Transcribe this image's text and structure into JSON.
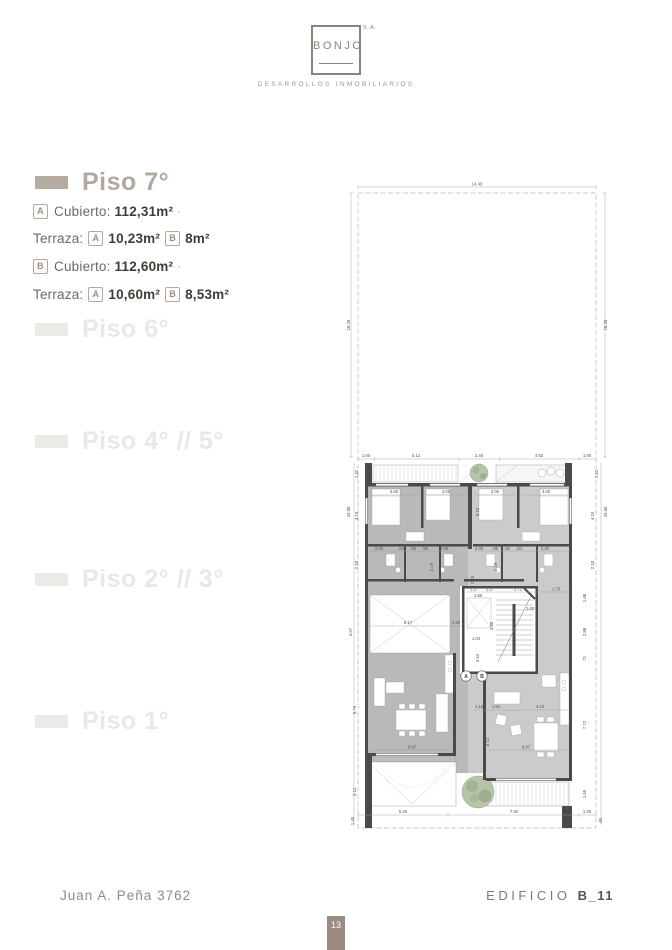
{
  "header": {
    "logo_text": "BONJO",
    "logo_suffix": "S.A.",
    "tagline": "DESARROLLOS INMOBILIARIOS"
  },
  "sidebar": {
    "active": {
      "title": "Piso 7°",
      "line1": {
        "badge": "A",
        "label": "Cubierto:",
        "value": "112,31",
        "unit": "m²",
        "dot": "·"
      },
      "line2": {
        "label": "Terraza:",
        "badge_a": "A",
        "value_a": "10,23",
        "unit_a": "m²",
        "badge_b": "B",
        "value_b": "8",
        "unit_b": "m²"
      },
      "line3": {
        "badge": "B",
        "label": "Cubierto:",
        "value": "112,60",
        "unit": "m²",
        "dot": "·"
      },
      "line4": {
        "label": "Terraza:",
        "badge_a": "A",
        "value_a": "10,60",
        "unit_a": "m²",
        "badge_b": "B",
        "value_b": "8,53",
        "unit_b": "m²"
      }
    },
    "floors": [
      {
        "label": "Piso 6°"
      },
      {
        "label": "Piso 4° // 5°"
      },
      {
        "label": "Piso 2° // 3°"
      },
      {
        "label": "Piso 1°"
      }
    ]
  },
  "plan": {
    "width_total": "14.40",
    "lot_depth_left": "18.28",
    "lot_depth_right": "18.28",
    "front_row": [
      "1.00",
      "5.12",
      "2.46",
      "4.82",
      "1.00"
    ],
    "terrace_depth_left": "1.42",
    "terrace_depth_right": "1.42",
    "overall_left": "43.50",
    "overall_right": "43.50",
    "bed_depth_left": "4.19",
    "bed_depth_right": "4.19",
    "bath_depth_left": "2.10",
    "bath_depth_right": "2.10",
    "bedroom_widths": [
      "3.60",
      "3.05",
      "3.05",
      "3.60"
    ],
    "bed_inner_v": "3.10",
    "bath_v_left": "2.19",
    "bath_v_right": "2.19",
    "inner_left": [
      "2.00",
      ".84",
      ".60",
      ".95",
      "2.00"
    ],
    "inner_right": [
      "2.00",
      ".95",
      ".60",
      ".84",
      "2.30"
    ],
    "core_top": [
      "1.17",
      "1.17",
      "2.71",
      "1.70"
    ],
    "elevator_w": "1.80",
    "core_w": "1.00",
    "study_w": "6.17",
    "pass_w": "1.20",
    "hall_w": "1.04",
    "core_v1": "2.20",
    "core_v2": "4.80",
    "hall_v": "3.53",
    "left_mid_v": "4.97",
    "right_v": [
      "1.68",
      "2.88",
      ".71"
    ],
    "living_v_left": "6.75",
    "living_v_right": "7.72",
    "living_row": [
      "1.16",
      "1.91",
      "4.13"
    ],
    "living_v_mid": "4.13",
    "living_w_left": "6.87",
    "living_w_right": "6.87",
    "terrace_v_left": "3.12",
    "terrace_v_right": "1.55",
    "bottom_row": [
      "5.46",
      "7.92",
      "1.00"
    ],
    "bottom_left_v": "1.45",
    "bottom_right_v": ".45",
    "unit_a": "A",
    "unit_b": "B"
  },
  "footer": {
    "address": "Juan A. Peña 3762",
    "building_label": "EDIFICIO",
    "building_code": "B_11",
    "page_number": "13"
  },
  "colors": {
    "brand": "#8d8379",
    "brand_light": "#b4aba1",
    "page_tab": "#9a8c7f",
    "wall": "#4a4a4a",
    "room_a": "#b9b9b9",
    "room_b": "#cbcbcb",
    "tree": "#b7c3aa"
  }
}
